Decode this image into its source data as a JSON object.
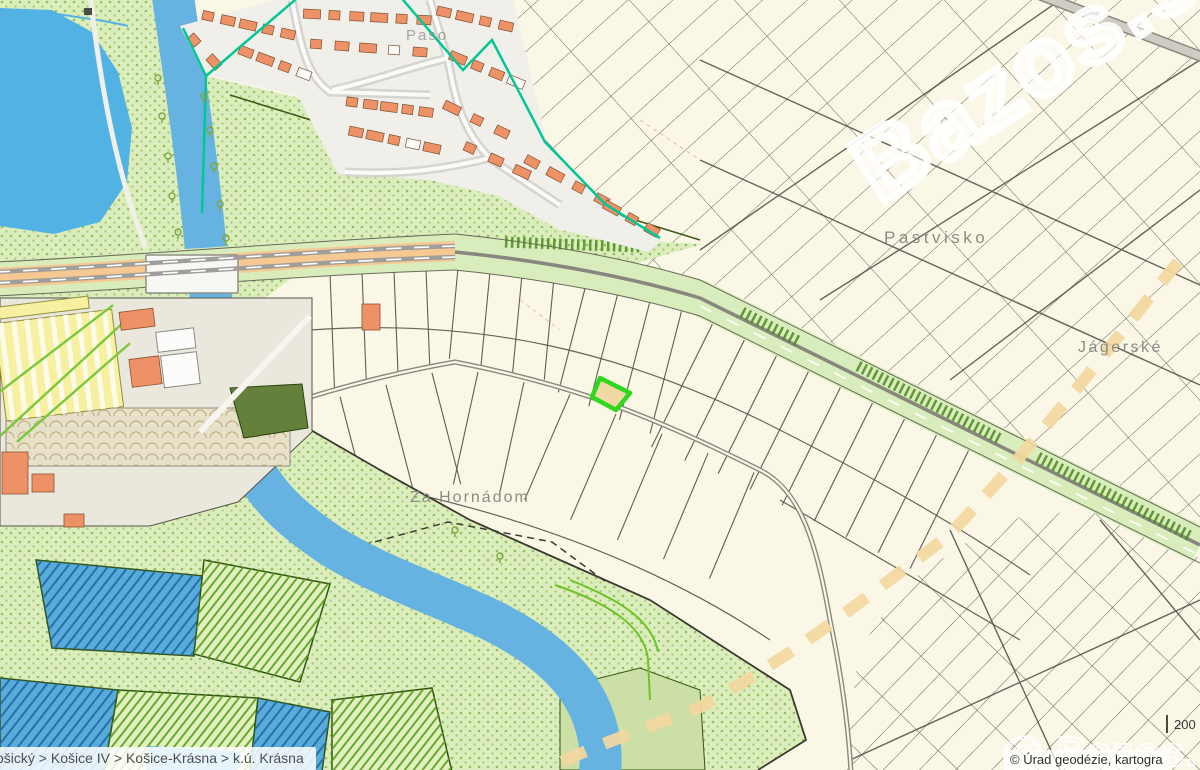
{
  "map": {
    "place_labels": [
      {
        "text": "Pastvisko",
        "x": 884,
        "y": 243,
        "size": 17,
        "ls": 3.5,
        "opacity": 1
      },
      {
        "text": "Jágerské",
        "x": 1078,
        "y": 352,
        "size": 16,
        "ls": 2.5,
        "opacity": 1
      },
      {
        "text": "Za Hornádom",
        "x": 410,
        "y": 502,
        "size": 16,
        "ls": 2,
        "opacity": 1
      },
      {
        "text": "Paso",
        "x": 406,
        "y": 40,
        "size": 15,
        "ls": 2,
        "opacity": 0.75
      }
    ],
    "breadcrumb": {
      "text": "ošický > Košice IV > Košice-Krásna > k.ú. Krásna"
    },
    "attribution": {
      "text": "© Úrad geodézie, kartogra"
    },
    "scale_bar": {
      "label": "200 m"
    },
    "watermark": {
      "corner": "@ Bazos.sk",
      "large": "Bazos.sk"
    },
    "selected_parcel": {
      "stroke": "#2fd81e",
      "fill": "#f2d8a4"
    },
    "colors": {
      "parcel_fill": "#faf7e7",
      "vegetation": "#dcedbd",
      "water": "#57b2e4",
      "road_orange": "#f6c993",
      "boundary_teal": "#00c795",
      "building_orange": "#ef9166",
      "cadastral_line": "#4f4d45"
    }
  }
}
